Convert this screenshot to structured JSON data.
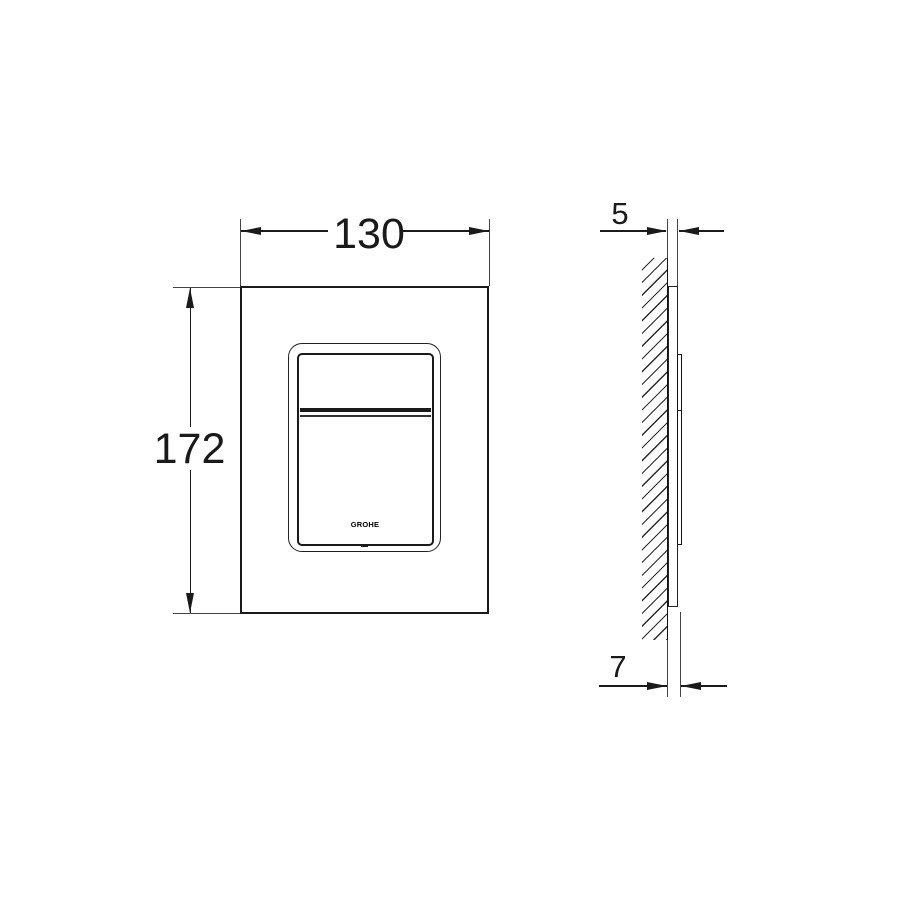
{
  "front_view": {
    "width_dim": "130",
    "height_dim": "172"
  },
  "side_view": {
    "plate_offset_dim": "5",
    "total_depth_dim": "7"
  },
  "plate": {
    "logo_text": "GROHE"
  },
  "colors": {
    "line": "#1a1a1a",
    "extension_line": "#444444",
    "background": "#ffffff"
  }
}
